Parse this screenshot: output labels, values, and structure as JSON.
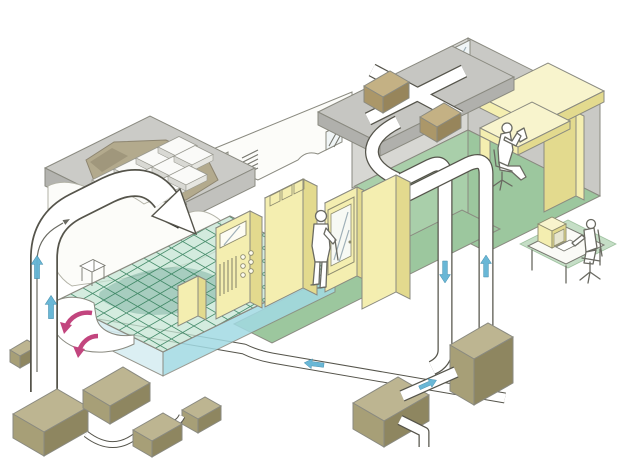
{
  "meta": {
    "title": "Isometric cutaway diagram of a cleanroom facility air-circulation (HVAC) system",
    "note": "technical illustration, no visible text labels"
  },
  "colors": {
    "background": "#ffffff",
    "outline": "#8a8a80",
    "duct_outline": "#55544b",
    "duct_fill": "#ffffff",
    "arrow_blue": "#62b4d4",
    "arrow_pink": "#c2457e",
    "wall_gray": "#d7d7d3",
    "wall_gray_dark": "#c9c9c5",
    "ceiling_top": "#cbcbc7",
    "ceiling_front": "#b3b3af",
    "ceiling_front2": "#c1c1bd",
    "strip_top": "#c6c6c2",
    "strip_front": "#b0b0ac",
    "green_floor": "#9cc79e",
    "green_wall": "#a9cfaa",
    "grid_line": "#2c7a55",
    "grid_base": "#c6e6d4",
    "plenum_left": "#d8eef2",
    "plenum_right": "#a2dae3",
    "underfloor_shadow": "#1f6e5e",
    "yellow_front": "#f4eeb0",
    "yellow_side": "#e3da8e",
    "yellow_top": "#f8f4cd",
    "olive_top": "#bdb591",
    "olive_front": "#a79f77",
    "olive_side": "#8e8660",
    "brown_top": "#c4b184",
    "brown_front": "#ab9769",
    "brown_side": "#97855b",
    "window_glass": "#f0f5f6",
    "white_wall": "#fcfcf9",
    "torn_edge": "#b2b2a6",
    "hole_fill": "#b3aa8d",
    "hole_shadow": "#8f8770",
    "box_dark_top": "#70706a",
    "box_dark_front": "#4b4b45",
    "box_dark_side": "#34342f",
    "figure_stroke": "#6a6a62"
  },
  "scene": {
    "rooms": [
      {
        "name": "cleanroom bay",
        "ceiling": "FFU filter ceiling plenum shown through torn cutaway",
        "floor": "perforated raised floor grid over translucent underfloor plenum"
      },
      {
        "name": "equipment corridor",
        "floor": "green",
        "contents": "yellow process cabinets, operator"
      },
      {
        "name": "office room",
        "floor": "green",
        "furniture": "L-shaped yellow desk",
        "windows": 3
      }
    ],
    "people": [
      {
        "name": "standing operator",
        "location": "corridor, at glass-door cabinet"
      },
      {
        "name": "seated worker",
        "location": "office desk, reading"
      },
      {
        "name": "engineer at computer",
        "location": "outside lower right, monitoring workstation with yellow monitor"
      }
    ],
    "equipment": {
      "ffu_filter_tiles": 11,
      "process_cabinets": 5,
      "panel_knobs": 6,
      "panel_slats": 5,
      "duct_fan_boxes_on_roof": 2,
      "hvac_ground_units": 7,
      "wall_control_box": 1,
      "underfloor_table": 1
    },
    "airflow": {
      "blue_arrows": [
        {
          "duct": "left supply riser",
          "direction": "up",
          "count": 2
        },
        {
          "duct": "right return riser",
          "direction": "down",
          "count": 1
        },
        {
          "duct": "right supply riser",
          "direction": "up",
          "count": 1
        },
        {
          "duct": "bottom return duct",
          "direction": "left",
          "count": 1
        },
        {
          "duct": "AHU cross-connect duct",
          "direction": "up-right",
          "count": 1
        }
      ],
      "pink_arrows": [
        {
          "location": "underfloor recirculation scoop",
          "direction": "curling down-left",
          "count": 2
        }
      ]
    }
  }
}
